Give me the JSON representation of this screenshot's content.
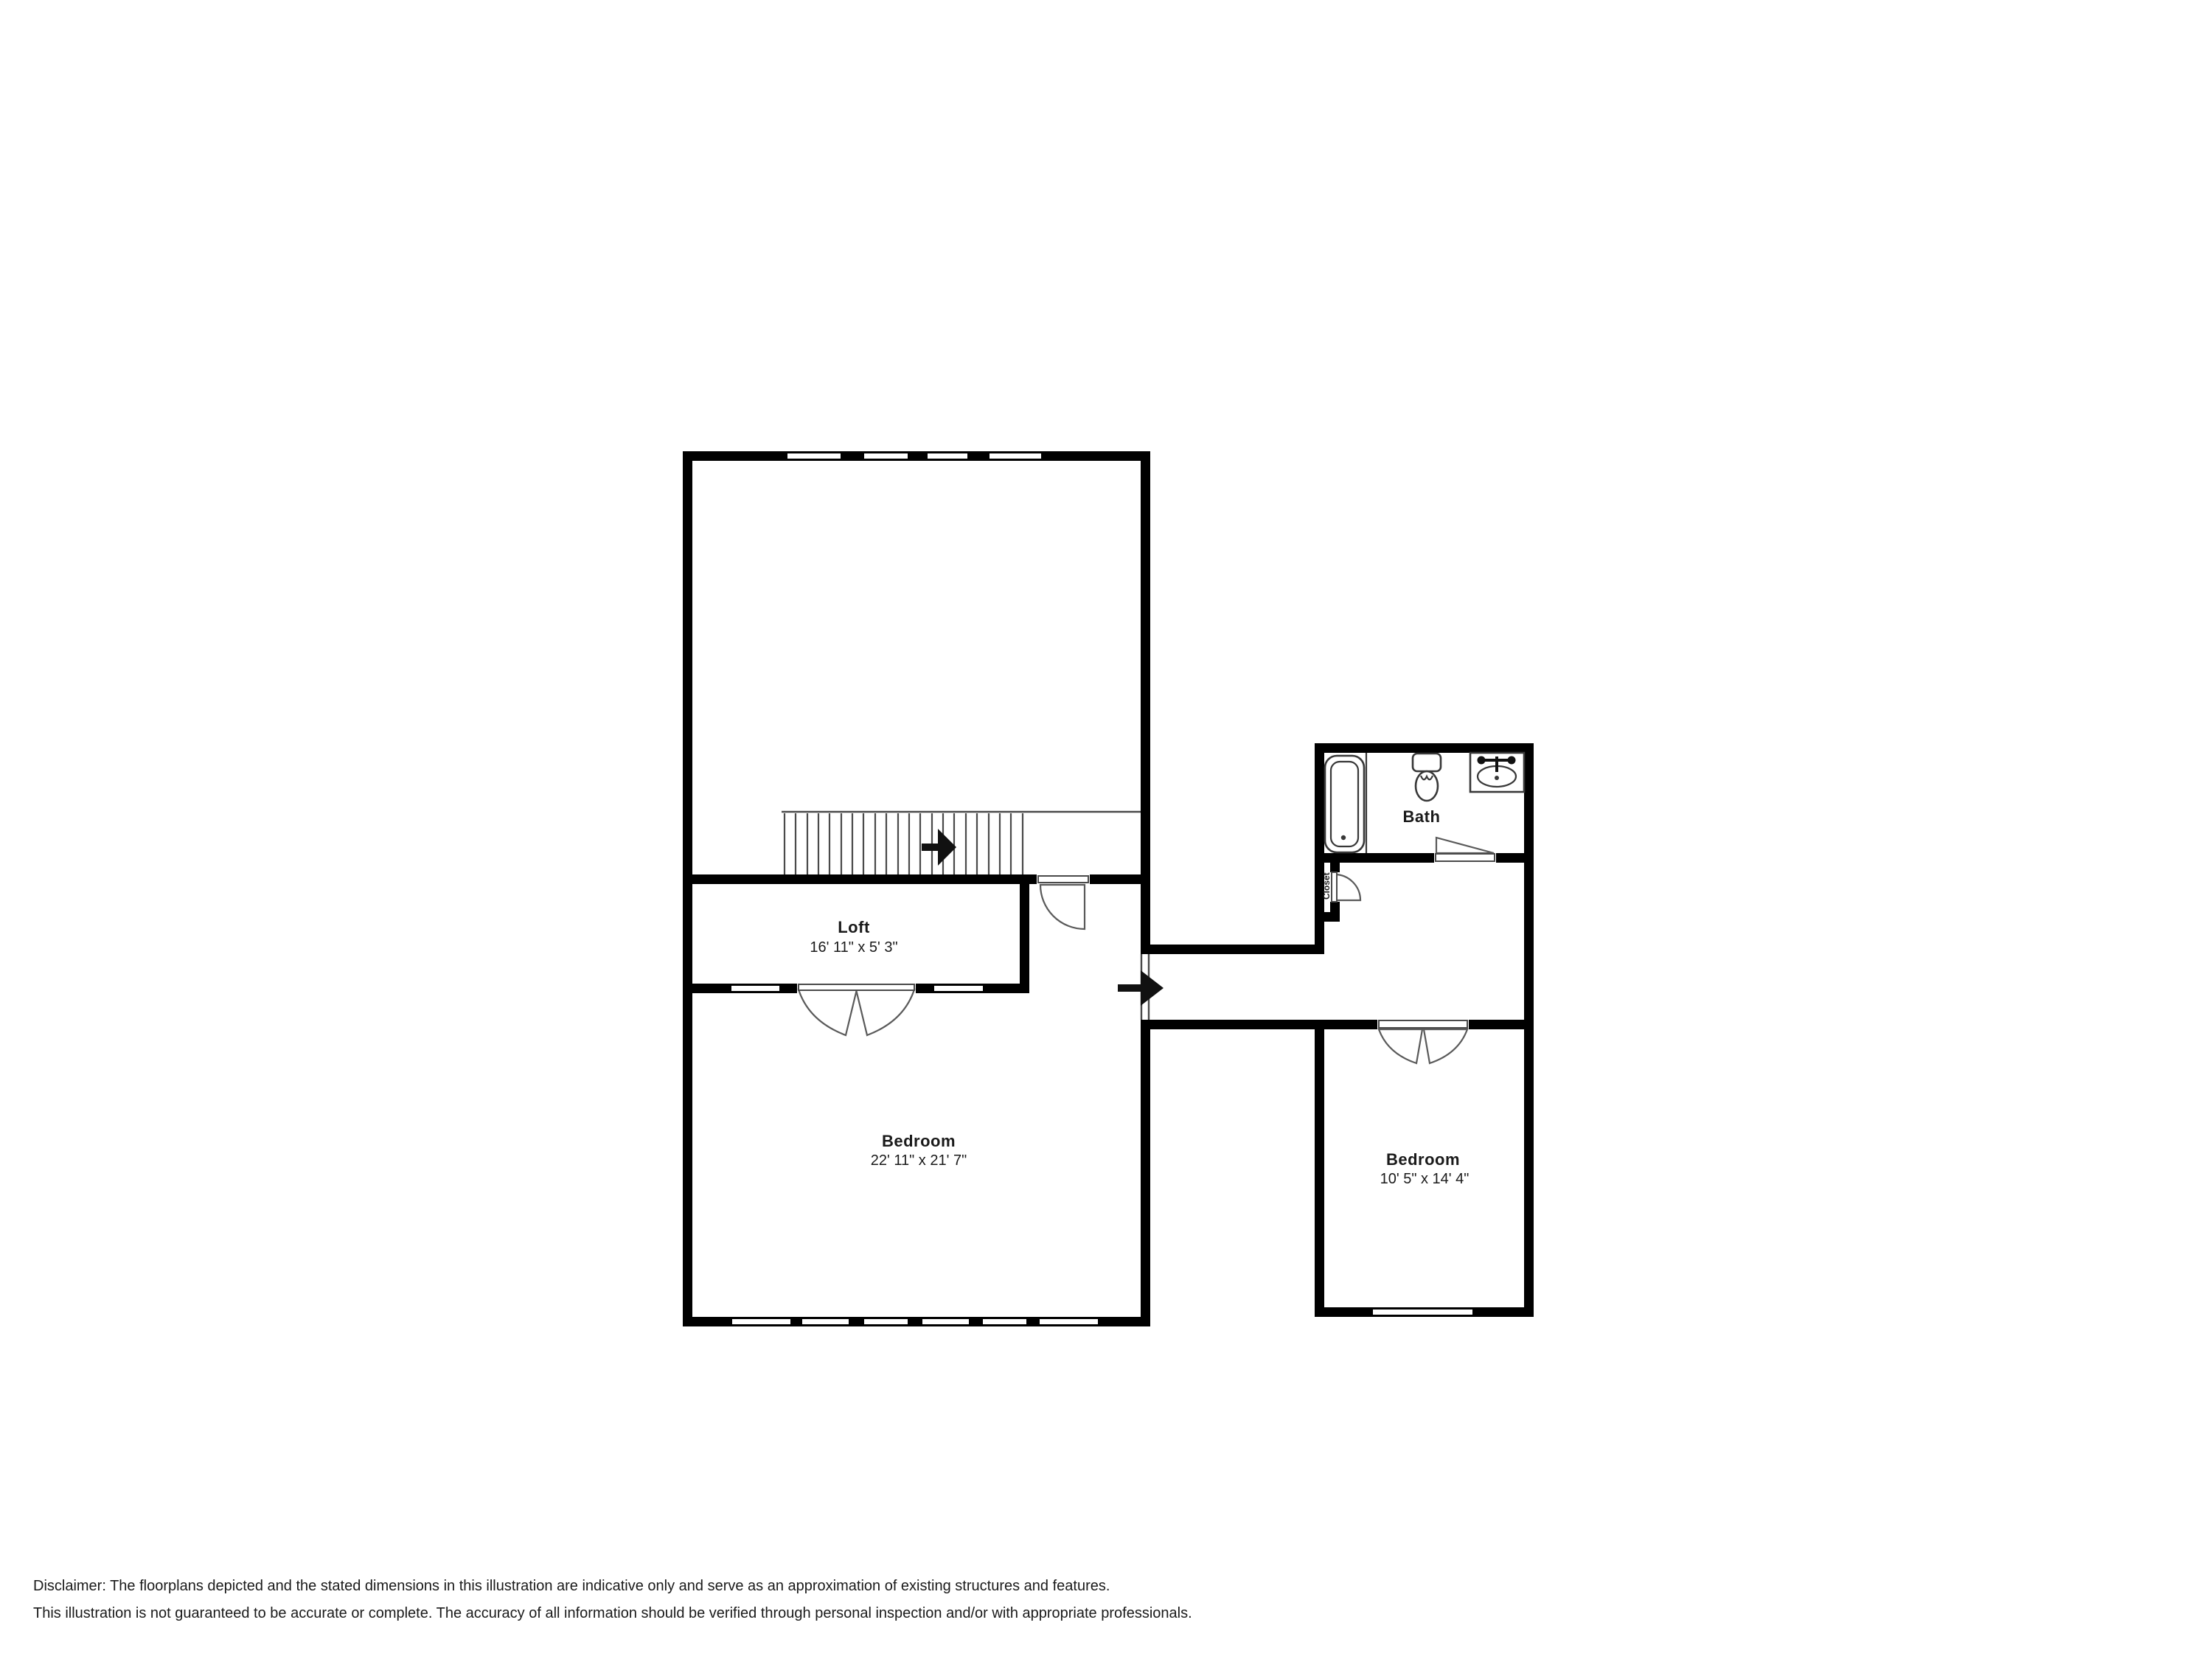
{
  "rooms": {
    "loft": {
      "name": "Loft",
      "dims": "16' 11\" x 5' 3\""
    },
    "bedroom_main": {
      "name": "Bedroom",
      "dims": "22' 11\" x 21' 7\""
    },
    "bath": {
      "name": "Bath"
    },
    "closet": {
      "name": "Closet"
    },
    "bedroom_second": {
      "name": "Bedroom",
      "dims": "10' 5\" x 14' 4\""
    }
  },
  "disclaimer": {
    "line1": "Disclaimer: The floorplans depicted and the stated dimensions in this illustration are indicative only and serve as an approximation of existing structures and features.",
    "line2": "This illustration is not guaranteed to be accurate or complete. The accuracy of all information should be verified through personal inspection and/or with appropriate professionals."
  },
  "colors": {
    "wall": "#000000",
    "line": "#4a4a4a",
    "label_text": "#1a1a1a",
    "disclaimer_text": "#a6b0ba",
    "background": "#ffffff"
  },
  "icons": {
    "stair-arrow-icon": "solid black right-pointing arrow",
    "entry-arrow-icon": "solid black right-pointing arrow",
    "bathtub-icon": "rounded rectangle tub with inner basin and drain dot",
    "toilet-icon": "tank rectangle with oval bowl",
    "sink-icon": "square counter with oval basin and faucet handles",
    "door-swing-icon": "quarter-circle swing arc",
    "window-icon": "white segment in wall band",
    "staircase-icon": "parallel tread lines"
  }
}
